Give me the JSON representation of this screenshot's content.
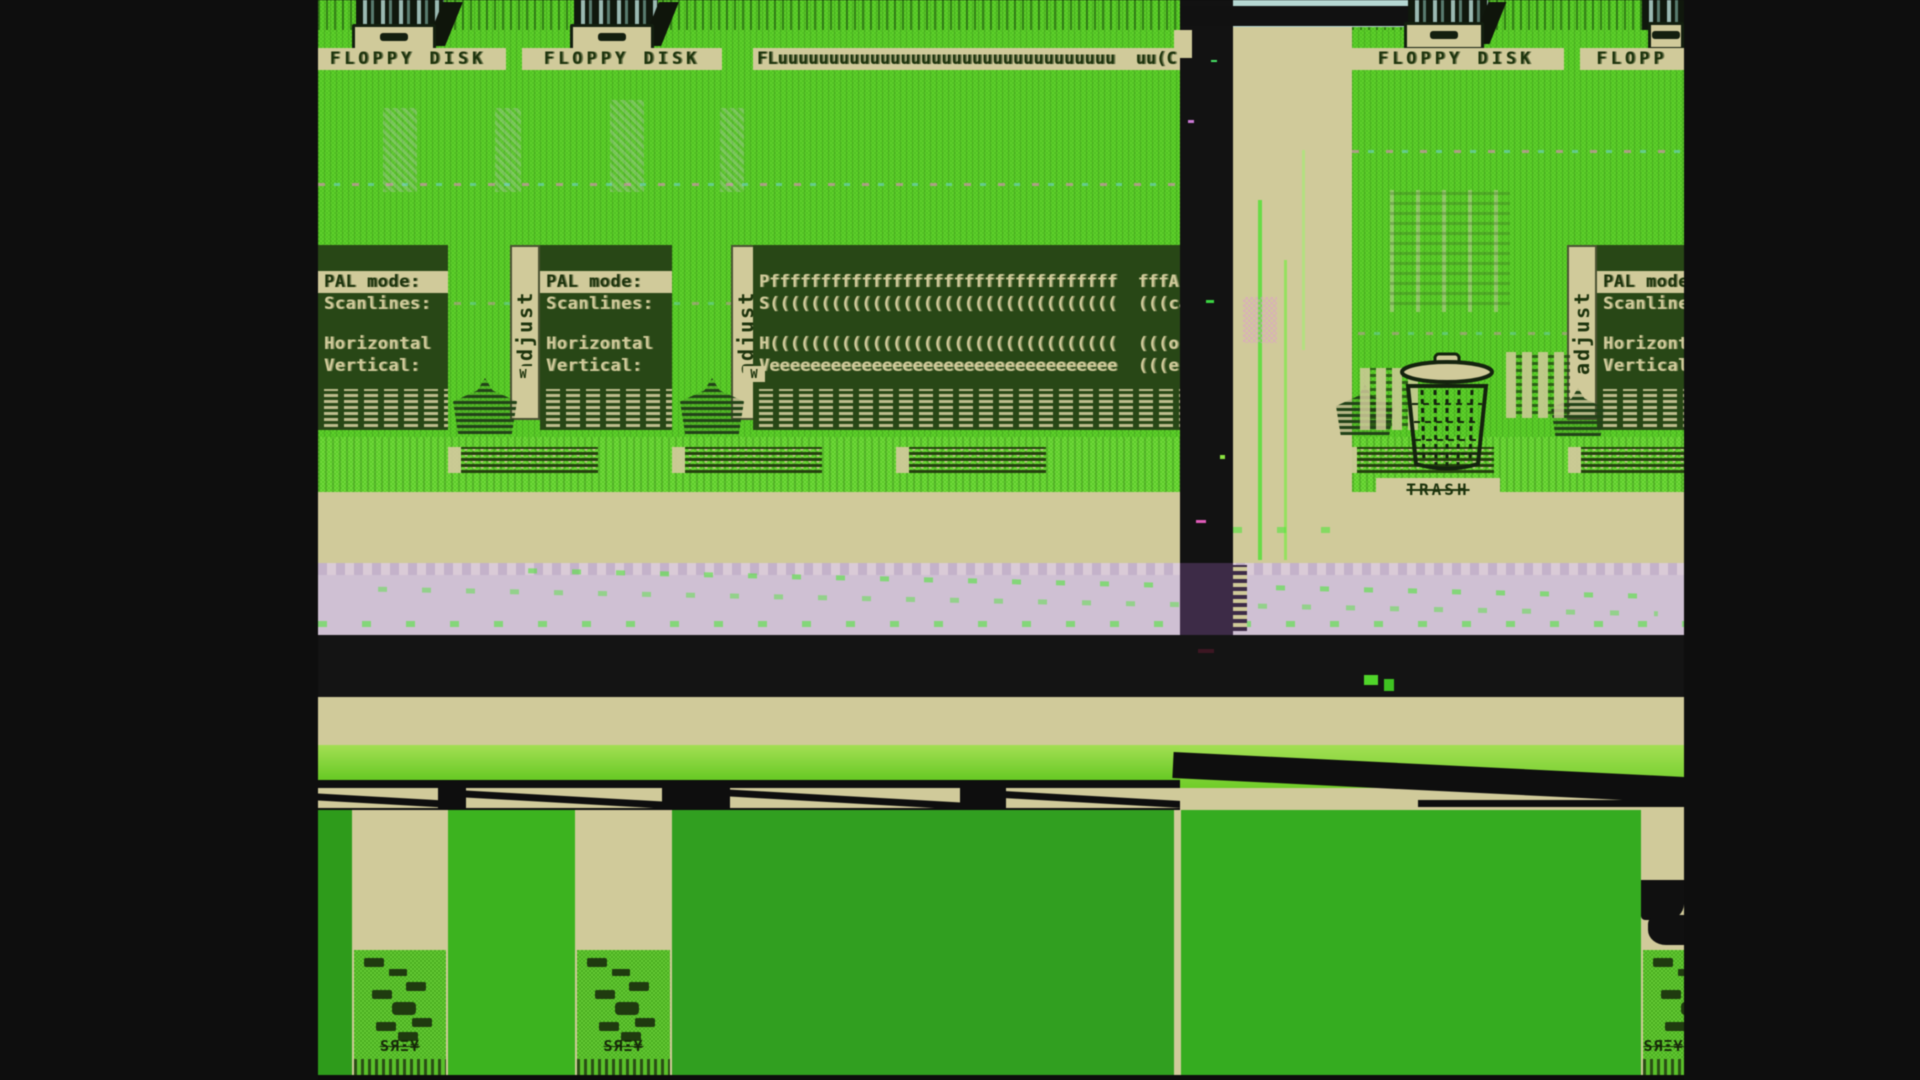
{
  "desktop": {
    "floppy_labels": [
      "FLOPPY DISK",
      "FLOPPY DISK",
      "FLuuuuuuuuuuuuuuuuuuuuuuuuuuuuuuuuu  uu(C",
      "FLOPPY DISK",
      "FLOPP"
    ],
    "trash_label": "TRASH"
  },
  "adjust_panels": {
    "tab_label": "adjust",
    "rows": [
      "PAL mode:",
      "Scanlines:",
      "Horizontal",
      "Vertical:"
    ],
    "smeared_rows": [
      "Pffffffffffffffffffffffffffffffffff  fffAL",
      "S((((((((((((((((((((((((((((((((((  (((ca",
      "H((((((((((((((((((((((((((((((((((  (((or",
      "Veeeeeeeeeeeeeeeeeeeeeeeeeeeeeeeeee  (((er"
    ]
  },
  "glitch": {
    "icon_label": "SЯΞ¥",
    "checkbox_glyph": "W"
  },
  "colors": {
    "backdrop": "#0e0e0e",
    "desktop_green_light": "#68cf37",
    "desktop_green": "#53bd2a",
    "panel_dark_green": "#2a4619",
    "tan": "#cfca9d",
    "sky_blue": "#b7d6d2",
    "lavender": "#cec0d2",
    "dark_purple": "#3c2b45",
    "ink_green": "#1e330f",
    "flat_green_a": "#349922",
    "flat_green_b": "#42b027",
    "flat_green_c": "#379d27",
    "flat_green_d": "#3ba928",
    "black_band": "#141414"
  }
}
